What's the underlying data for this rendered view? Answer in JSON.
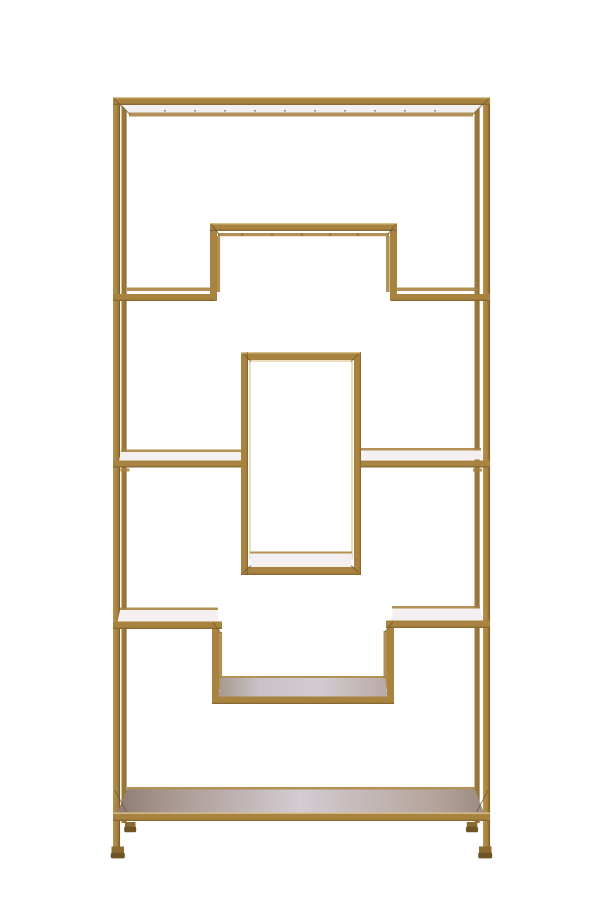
{
  "image": {
    "description": "Front view product photo of a tall rectangular gold metal etagere shelving unit with a geometric Greek-key style arrangement of open shelves, photographed on a plain white background",
    "background_color": "#ffffff"
  },
  "product": {
    "type": "etagere shelving unit",
    "frame_finish": "antique gold metal",
    "shelf_levels": 5,
    "parts": {
      "top_shelf": "full-width top shelf",
      "upper_step_shelf": "raised stepped shelf, second level",
      "left_mid_shelf": "left middle shelf",
      "right_mid_shelf": "right middle shelf",
      "center_box": "central rectangular display compartment with interior shelf",
      "lower_step_shelf": "recessed stepped shelf, fourth level",
      "bottom_shelf": "full-width solid bottom shelf",
      "feet": "four small gold feet"
    }
  },
  "colors": {
    "gold": "#a8823f",
    "gold-dark": "#8a6a30",
    "gold-deep": "#6f5526",
    "gold-light": "#c9a665",
    "gold-pale": "#e3cf9e",
    "gold-back": "#9a7838",
    "surface-white": "#f4f0f2",
    "surface-grey": "#d2cbd1",
    "surface-taupe": "#96857d",
    "bg": "#ffffff"
  }
}
